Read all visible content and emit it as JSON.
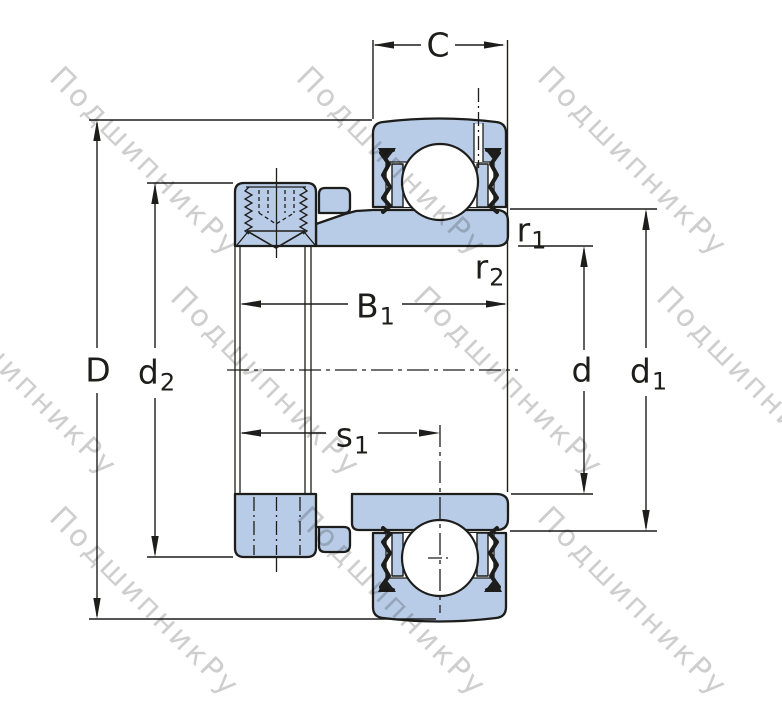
{
  "title": "bearing-cross-section-drawing",
  "watermark": {
    "text": "ПодшипникРу"
  },
  "dims": {
    "C": {
      "label": "C"
    },
    "B1": {
      "base": "B",
      "sub": "1"
    },
    "s1": {
      "base": "s",
      "sub": "1"
    },
    "D": {
      "label": "D"
    },
    "d2": {
      "base": "d",
      "sub": "2"
    },
    "d": {
      "label": "d"
    },
    "d1": {
      "base": "d",
      "sub": "1"
    },
    "r1": {
      "base": "r",
      "sub": "1"
    },
    "r2": {
      "base": "r",
      "sub": "2"
    }
  },
  "colors": {
    "part_fill": "#b9cce7",
    "line": "#1d1d1b",
    "watermark": "#c6c6c6",
    "background": "#ffffff",
    "ball_fill": "#ffffff"
  }
}
